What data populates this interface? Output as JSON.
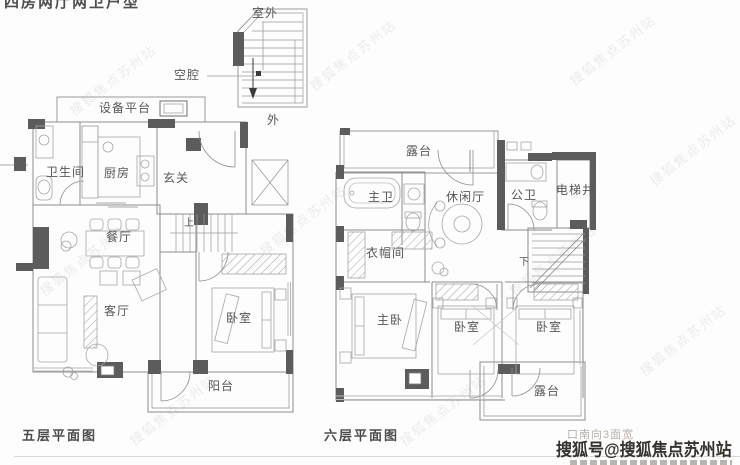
{
  "title": "四房两厅两卫户型",
  "floor5": {
    "caption": "五层平面图",
    "rooms": {
      "outdoor": "室外",
      "cavity": "空腔",
      "equipment": "设备平台",
      "exterior": "外",
      "bathroom": "卫生间",
      "kitchen": "厨房",
      "foyer": "玄关",
      "dining": "餐厅",
      "living": "客厅",
      "bedroom": "卧室",
      "balcony": "阳台",
      "stair_up": "上"
    }
  },
  "floor6": {
    "caption": "六层平面图",
    "rooms": {
      "terrace_top": "露台",
      "master_bath": "主卫",
      "leisure": "休闲厅",
      "public_bath": "公卫",
      "elevator": "电梯井",
      "cloakroom": "衣帽间",
      "master_bedroom": "主卧",
      "bedroom_a": "卧室",
      "bedroom_b": "卧室",
      "terrace_bottom": "露台",
      "stair_down": "下"
    }
  },
  "notes": {
    "south": "口南向3面宽"
  },
  "watermark": {
    "site": "搜狐号@搜狐焦点苏州站",
    "diagonal": "搜狐焦点苏州站"
  },
  "colors": {
    "wall_fill": "#5c5c5c",
    "line": "#9b9b9b",
    "caption": "#4c4c4c",
    "note": "#b7afa6",
    "watermark_main": "#37322d"
  }
}
